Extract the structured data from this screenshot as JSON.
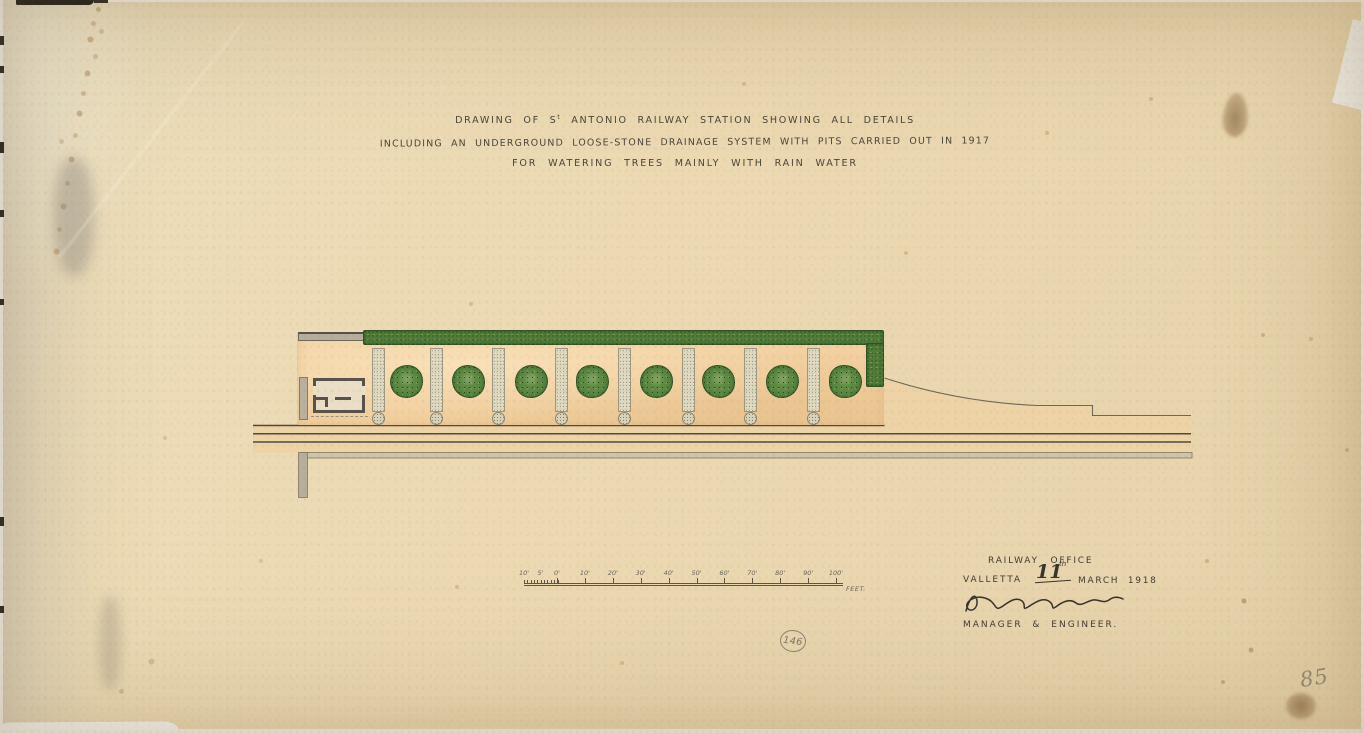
{
  "title": {
    "line1_pre": "DRAWING OF S",
    "line1_sup": "t",
    "line1_post": " ANTONIO RAILWAY STATION SHOWING ALL DETAILS",
    "line2": "INCLUDING AN UNDERGROUND LOOSE-STONE DRAINAGE SYSTEM WITH PITS CARRIED OUT IN 1917",
    "line3": "FOR WATERING TREES MAINLY WITH RAIN WATER"
  },
  "scale_bar": {
    "left_labels": [
      "10'",
      "5'",
      "0'"
    ],
    "main_labels": [
      "10'",
      "20'",
      "30'",
      "40'",
      "50'",
      "60'",
      "70'",
      "80'",
      "90'",
      "100'"
    ],
    "unit_label": "FEET."
  },
  "office": {
    "line1": "RAILWAY OFFICE",
    "place": "VALLETTA",
    "date_day": "11",
    "date_ordinal": "th",
    "date_rest": "MARCH 1918",
    "role": "MANAGER & ENGINEER."
  },
  "annotations": {
    "circled_number": "146",
    "corner_number": "85"
  },
  "plan": {
    "tree_count": 8,
    "pit_count": 8
  },
  "colors": {
    "paper": "#ead9b3",
    "platform_wash": "#f2d0a0",
    "hedge_green": "#517b38",
    "tree_green": "#5e8a44",
    "ink": "#4a443a",
    "pencil": "#958b79"
  }
}
